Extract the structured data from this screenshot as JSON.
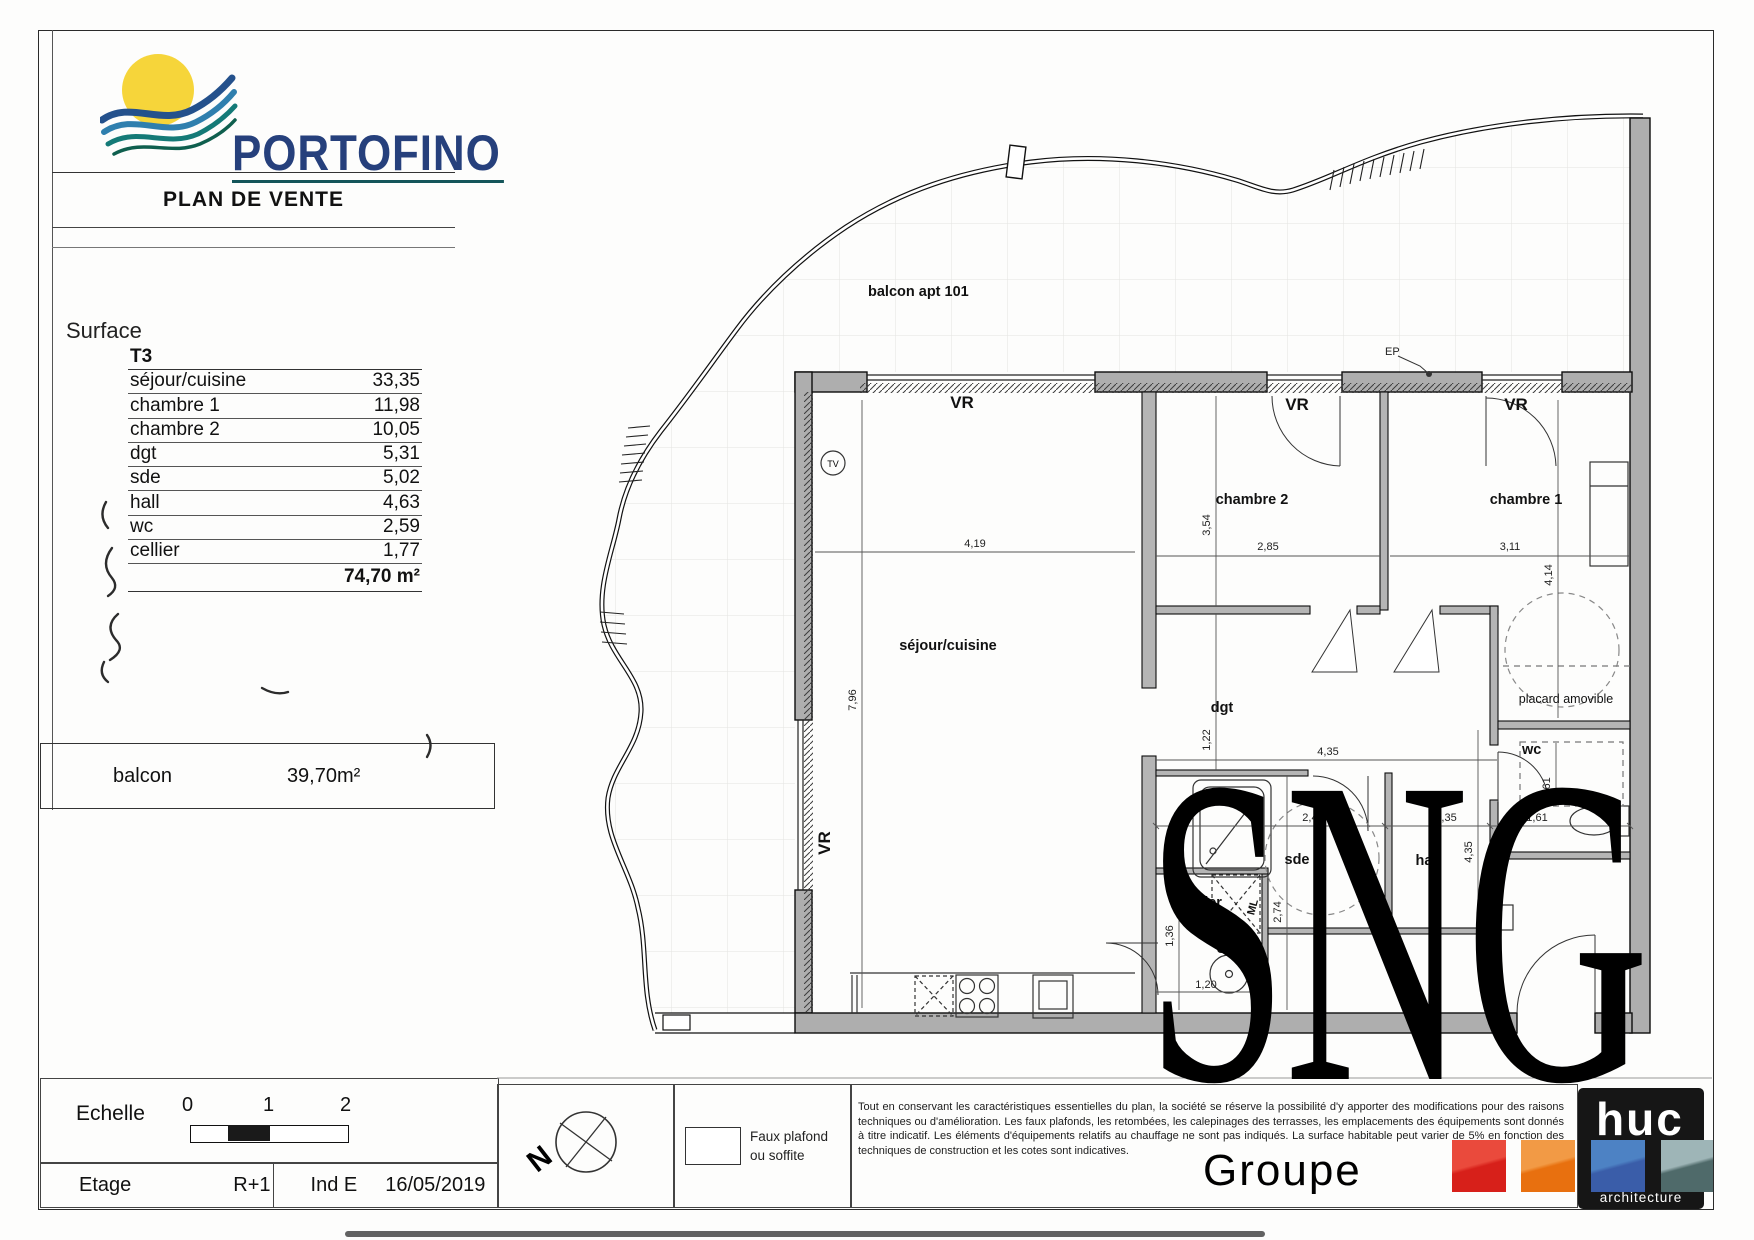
{
  "title_block": {
    "brand": "PORTOFINO",
    "doc_title": "PLAN DE VENTE",
    "surface_label": "Surface",
    "type_label": "T3",
    "rows": [
      {
        "label": "séjour/cuisine",
        "value": "33,35"
      },
      {
        "label": "chambre 1",
        "value": "11,98"
      },
      {
        "label": "chambre 2",
        "value": "10,05"
      },
      {
        "label": "dgt",
        "value": "5,31"
      },
      {
        "label": "sde",
        "value": "5,02"
      },
      {
        "label": "hall",
        "value": "4,63"
      },
      {
        "label": "wc",
        "value": "2,59"
      },
      {
        "label": "cellier",
        "value": "1,77"
      }
    ],
    "total": "74,70 m²",
    "balcon_label": "balcon",
    "balcon_value": "39,70m²"
  },
  "footer": {
    "echelle_label": "Echelle",
    "scale_ticks": [
      "0",
      "1",
      "2"
    ],
    "etage_label": "Etage",
    "etage_value": "R+1",
    "ind_label": "Ind E",
    "date": "16/05/2019",
    "north_letter": "N",
    "legend_line1": "Faux plafond",
    "legend_line2": "ou soffite",
    "disclaimer": "Tout en conservant les caractéristiques essentielles du plan, la société se réserve la possibilité d'y apporter des modifications pour des raisons techniques ou d'amélioration. Les faux plafonds, les retombées, les calepinages des terrasses, les emplacements des équipements sont donnés à titre indicatif. Les éléments d'équipements relatifs au chauffage ne sont pas indiqués. La surface habitable peut varier de 5% en fonction des techniques de construction et les cotes sont indicatives."
  },
  "watermark": {
    "text": "SNG",
    "subtext": "Groupe"
  },
  "huc": {
    "name": "huc",
    "subtitle": "architecture",
    "colors": [
      "#d7201a",
      "#e8700f",
      "#3a5da9",
      "#4f6a6a"
    ]
  },
  "brand_colors": {
    "navy": "#26407c",
    "teal": "#14555a",
    "sun": "#f6d53a"
  },
  "plan": {
    "labels": {
      "balcon": "balcon apt 101",
      "vr": "VR",
      "ep": "EP",
      "tv": "TV",
      "sejour": "séjour/cuisine",
      "chambre2": "chambre 2",
      "chambre1": "chambre 1",
      "dgt": "dgt",
      "sde": "sde",
      "hall": "hall",
      "cellier": "cellier",
      "wc": "wc",
      "placard": "placard amovible",
      "ml": "ML",
      "gtl": "GTL",
      "ce": "CE 1"
    },
    "dims": {
      "sejour_w": "4,19",
      "sejour_h": "7,96",
      "ch2_h": "3,54",
      "ch2_w": "2,85",
      "ch1_w": "3,11",
      "ch1_h": "4,14",
      "dgt_h": "1,22",
      "dgt_w": "4,35",
      "sde_w": "2,43",
      "sde_h": "2,74",
      "hall_w": "1,35",
      "hall_h": "4,35",
      "wc_w": "1,61",
      "wc_h": "1,61",
      "cellier_h": "1,36",
      "cellier_w": "1,20"
    }
  }
}
